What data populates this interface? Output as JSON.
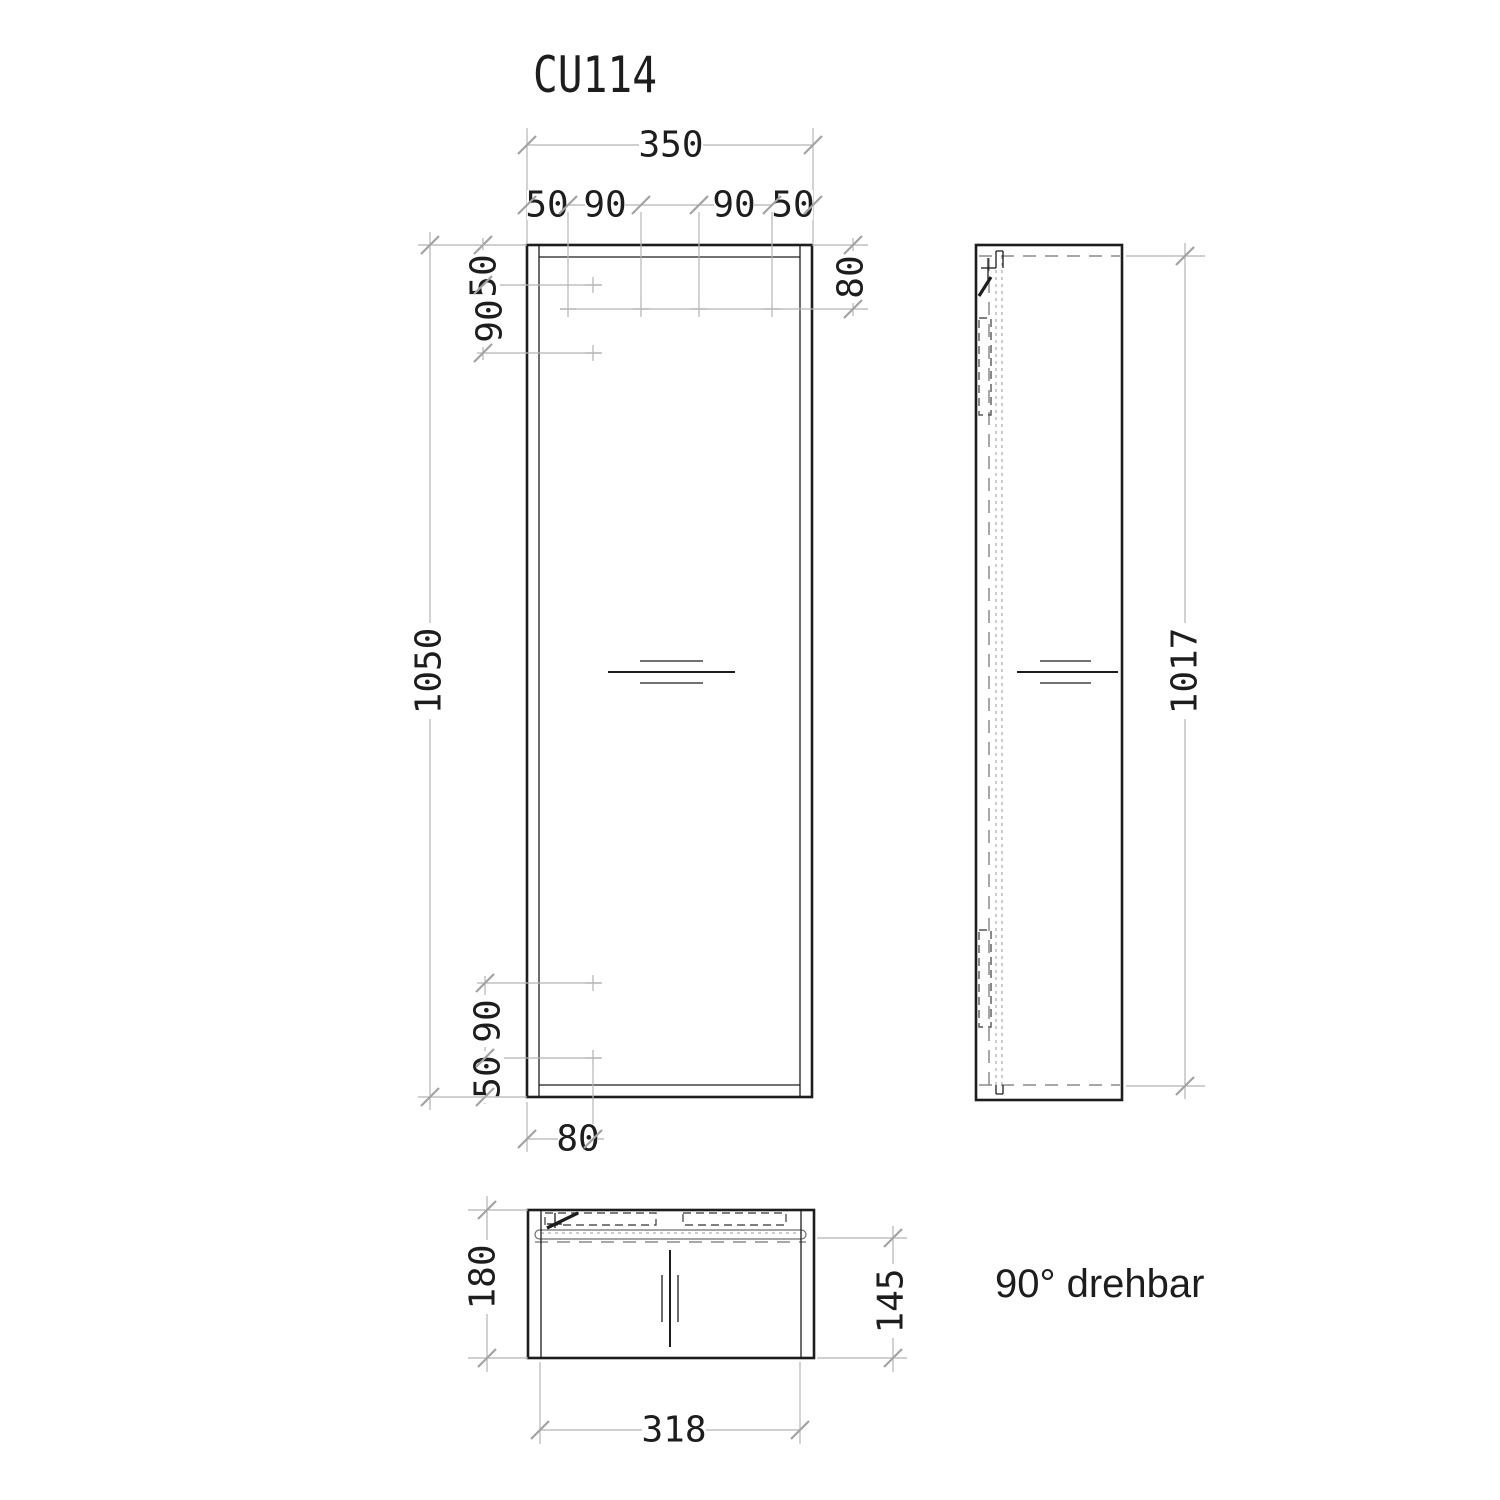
{
  "title": "CU114",
  "note": "90° drehbar",
  "colors": {
    "ink": "#1d1d1d",
    "dimension_lines": "#b5b5b5",
    "hidden_lines": "#8c8c8c"
  },
  "front_view": {
    "dim_total_width": "350",
    "dim_hinge_offset_left": "50",
    "dim_hinge_spacing_left": "90",
    "dim_hinge_spacing_right": "90",
    "dim_hinge_offset_right": "50",
    "dim_top_row_depth": "80",
    "dim_side_top_offset": "50",
    "dim_side_top_spacing": "90",
    "dim_side_bottom_spacing": "90",
    "dim_side_bottom_offset": "50",
    "dim_height": "1050",
    "dim_hole_column_offset": "80"
  },
  "side_view": {
    "dim_door_height": "1017"
  },
  "top_view": {
    "dim_depth": "180",
    "dim_door_to_back": "145",
    "dim_door_width": "318"
  }
}
